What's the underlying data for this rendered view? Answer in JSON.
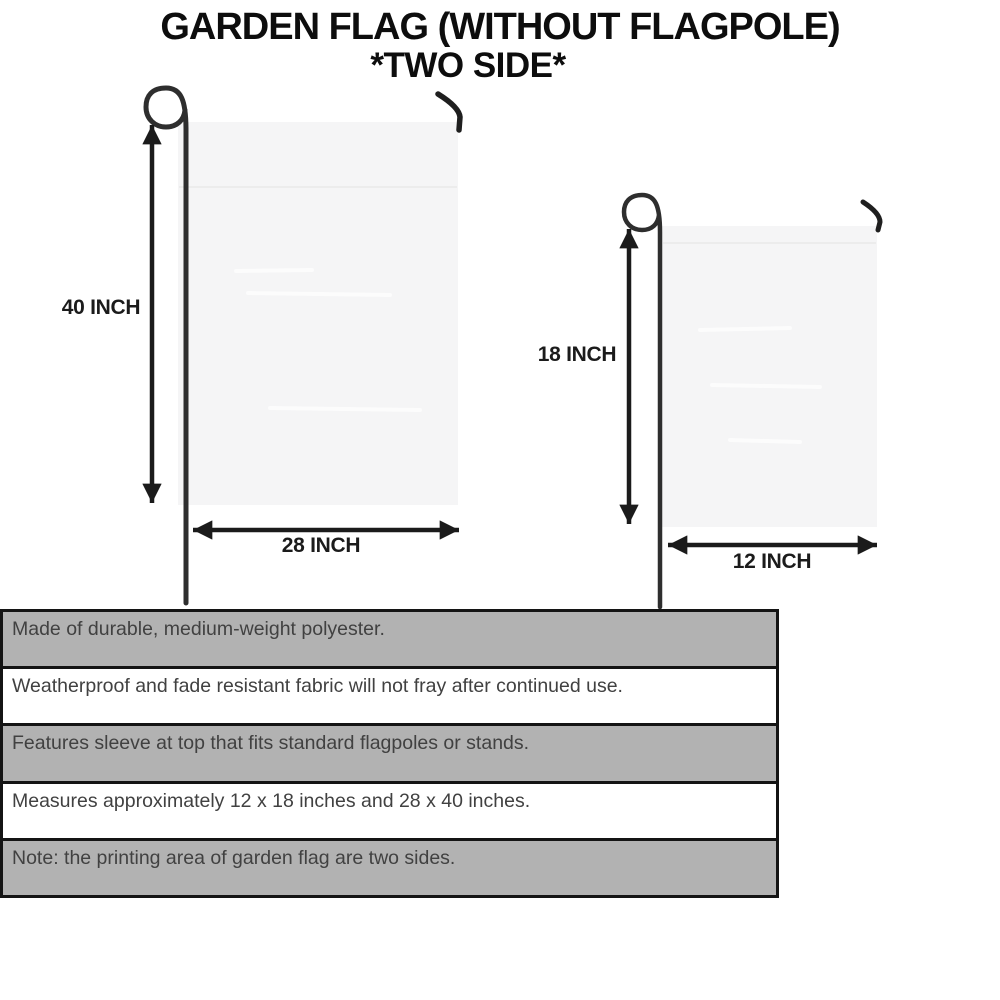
{
  "title": {
    "line1": "GARDEN FLAG (WITHOUT FLAGPOLE)",
    "line2": "*TWO SIDE*"
  },
  "diagram": {
    "large_flag": {
      "height_label": "40 INCH",
      "width_label": "28 INCH"
    },
    "small_flag": {
      "height_label": "18 INCH",
      "width_label": "12 INCH"
    }
  },
  "features": {
    "rows": [
      {
        "text": "Made of durable, medium-weight polyester.",
        "background": "gray"
      },
      {
        "text": "Weatherproof and fade resistant fabric will not fray after continued use.",
        "background": "white"
      },
      {
        "text": "Features sleeve at top that fits standard flagpoles or stands.",
        "background": "gray"
      },
      {
        "text": "Measures approximately 12 x 18 inches and 28 x 40 inches.",
        "background": "white"
      },
      {
        "text": "Note: the printing area of garden flag are two sides.",
        "background": "gray"
      }
    ]
  },
  "colors": {
    "background": "#ffffff",
    "title_text": "#0d0d0d",
    "label_text": "#1b1b1b",
    "arrow": "#1b1b1b",
    "pole": "#2e2e2e",
    "flag_fill": "#f5f5f6",
    "flag_seam": "#ececec",
    "row_gray": "#b2b2b2",
    "row_border": "#141414",
    "row_text": "#414141"
  }
}
